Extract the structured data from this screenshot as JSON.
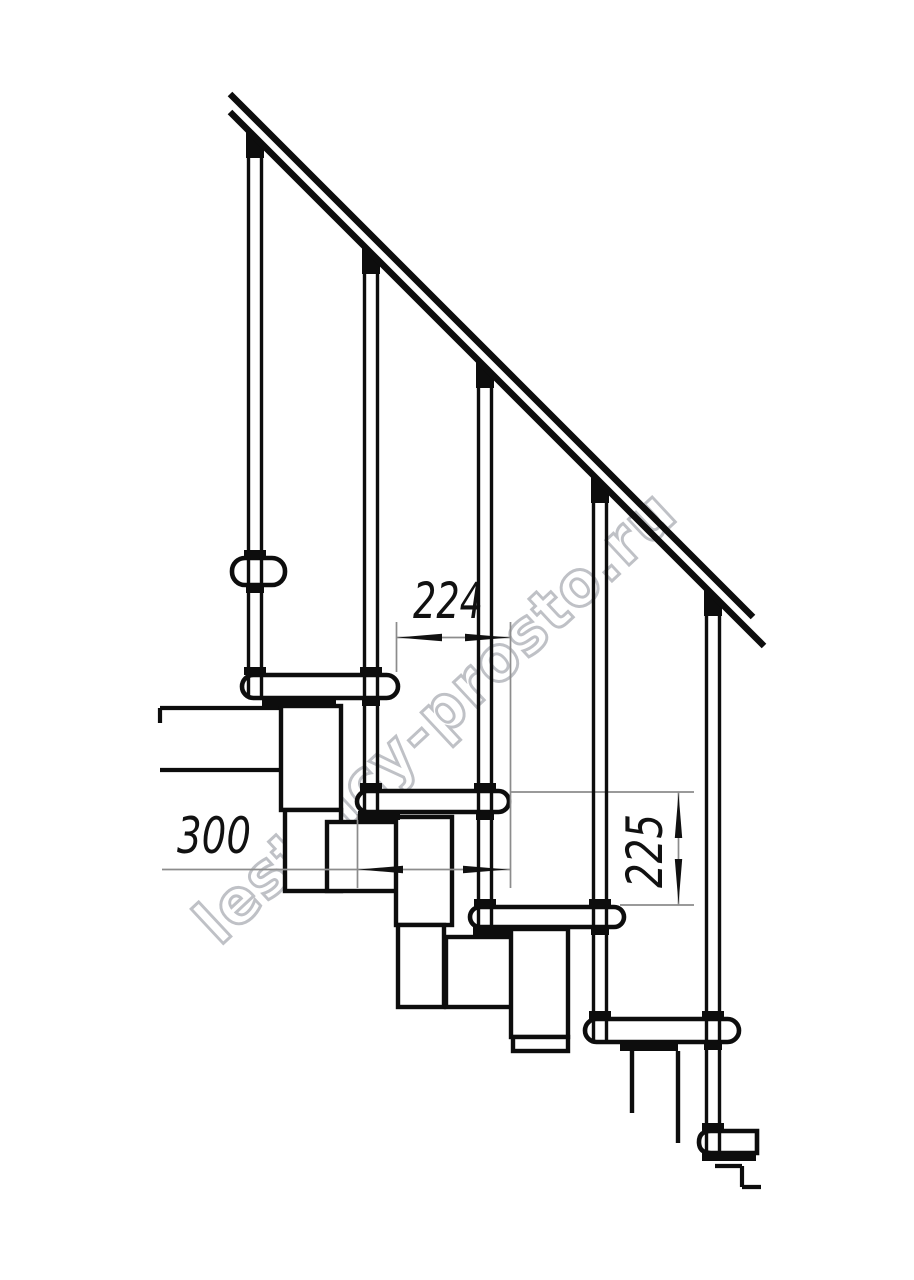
{
  "drawing": {
    "kind": "staircase-side-elevation-technical-drawing",
    "structure": {
      "balusters": 5,
      "treads": 6,
      "handrail": 1
    }
  },
  "dimensions": {
    "run": {
      "value": "224",
      "orientation": "horizontal"
    },
    "tread_depth": {
      "value": "300",
      "orientation": "horizontal"
    },
    "rise": {
      "value": "225",
      "orientation": "vertical"
    }
  },
  "watermark": {
    "text": "lestnicy-prosto.ru"
  },
  "colors": {
    "line": "#0d0d0d",
    "dimension_line": "#8c8c8c",
    "arrow": "#111111",
    "watermark_outline": "#bfc1c6",
    "background": "#ffffff"
  }
}
